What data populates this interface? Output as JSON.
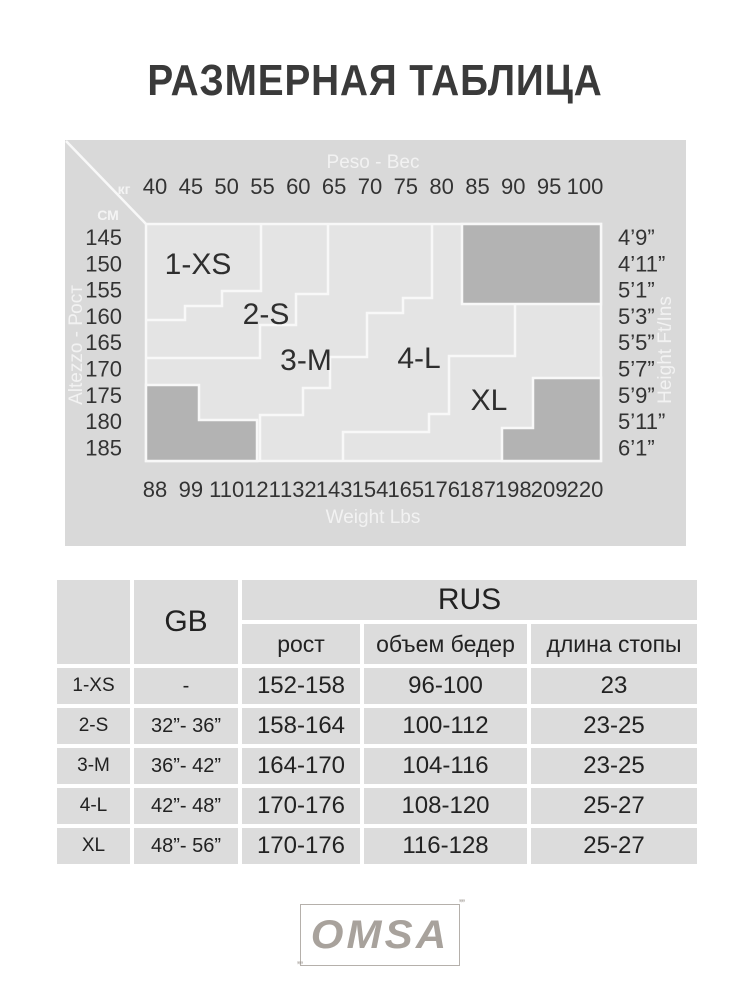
{
  "title": "РАЗМЕРНАЯ ТАБЛИЦА",
  "chart": {
    "top_axis": {
      "label": "Peso - Вес",
      "unit": "кг",
      "ticks": [
        "40",
        "45",
        "50",
        "55",
        "60",
        "65",
        "70",
        "75",
        "80",
        "85",
        "90",
        "95",
        "100"
      ]
    },
    "bottom_axis": {
      "label": "Weight Lbs",
      "ticks": [
        "88",
        "99",
        "110",
        "121",
        "132",
        "143",
        "154",
        "165",
        "176",
        "187",
        "198",
        "209",
        "220"
      ]
    },
    "left_axis": {
      "label": "Altezzo - Рост",
      "unit": "СМ",
      "ticks": [
        "145",
        "150",
        "155",
        "160",
        "165",
        "170",
        "175",
        "180",
        "185"
      ]
    },
    "right_axis": {
      "label": "Height Ft/Ins",
      "ticks": [
        "4’9”",
        "4’11”",
        "5’1”",
        "5’3”",
        "5’5”",
        "5’7”",
        "5’9”",
        "5’11”",
        "6’1”"
      ]
    },
    "region_labels": [
      "1-XS",
      "2-S",
      "3-M",
      "4-L",
      "XL"
    ],
    "colors": {
      "panel_bg": "#d9d9d9",
      "plot_bg": "#e4e4e4",
      "blocked_area": "#b3b3b3",
      "grid_line": "#f8f8f8",
      "tick_text": "#333333"
    }
  },
  "chart_data": {
    "type": "heatmap",
    "title": "РАЗМЕРНАЯ ТАБЛИЦА",
    "x_axis": {
      "label_top": "Peso - Вес (кг)",
      "ticks_kg": [
        40,
        45,
        50,
        55,
        60,
        65,
        70,
        75,
        80,
        85,
        90,
        95,
        100
      ],
      "label_bottom": "Weight Lbs",
      "ticks_lbs": [
        88,
        99,
        110,
        121,
        132,
        143,
        154,
        165,
        176,
        187,
        198,
        209,
        220
      ]
    },
    "y_axis": {
      "label_left": "Altezzo - Рост (СМ)",
      "ticks_cm": [
        145,
        150,
        155,
        160,
        165,
        170,
        175,
        180,
        185
      ],
      "label_right": "Height Ft/Ins",
      "ticks_ftins": [
        "4’9”",
        "4’11”",
        "5’1”",
        "5’3”",
        "5’5”",
        "5’7”",
        "5’9”",
        "5’11”",
        "6’1”"
      ]
    },
    "regions": [
      {
        "label": "1-XS",
        "approx_weight_kg": [
          40,
          55
        ],
        "approx_height_cm": [
          145,
          158
        ]
      },
      {
        "label": "2-S",
        "approx_weight_kg": [
          42,
          62
        ],
        "approx_height_cm": [
          145,
          164
        ]
      },
      {
        "label": "3-M",
        "approx_weight_kg": [
          48,
          75
        ],
        "approx_height_cm": [
          145,
          185
        ]
      },
      {
        "label": "4-L",
        "approx_weight_kg": [
          58,
          88
        ],
        "approx_height_cm": [
          145,
          185
        ]
      },
      {
        "label": "XL",
        "approx_weight_kg": [
          72,
          100
        ],
        "approx_height_cm": [
          152,
          185
        ]
      }
    ],
    "note": "Stepped region map; dark gray corner areas = sizes not available"
  },
  "table": {
    "gb_header": "GB",
    "rus_header": "RUS",
    "sub_headers": [
      "рост",
      "объем бедер",
      "длина стопы"
    ],
    "rows": [
      {
        "size": "1-XS",
        "gb": "-",
        "rost": "152-158",
        "hips": "96-100",
        "foot": "23"
      },
      {
        "size": "2-S",
        "gb": "32”- 36”",
        "rost": "158-164",
        "hips": "100-112",
        "foot": "23-25"
      },
      {
        "size": "3-M",
        "gb": "36”- 42”",
        "rost": "164-170",
        "hips": "104-116",
        "foot": "23-25"
      },
      {
        "size": "4-L",
        "gb": "42”- 48”",
        "rost": "170-176",
        "hips": "108-120",
        "foot": "25-27"
      },
      {
        "size": "XL",
        "gb": "48”- 56”",
        "rost": "170-176",
        "hips": "116-128",
        "foot": "25-27"
      }
    ]
  },
  "logo": {
    "text": "OMSA"
  }
}
